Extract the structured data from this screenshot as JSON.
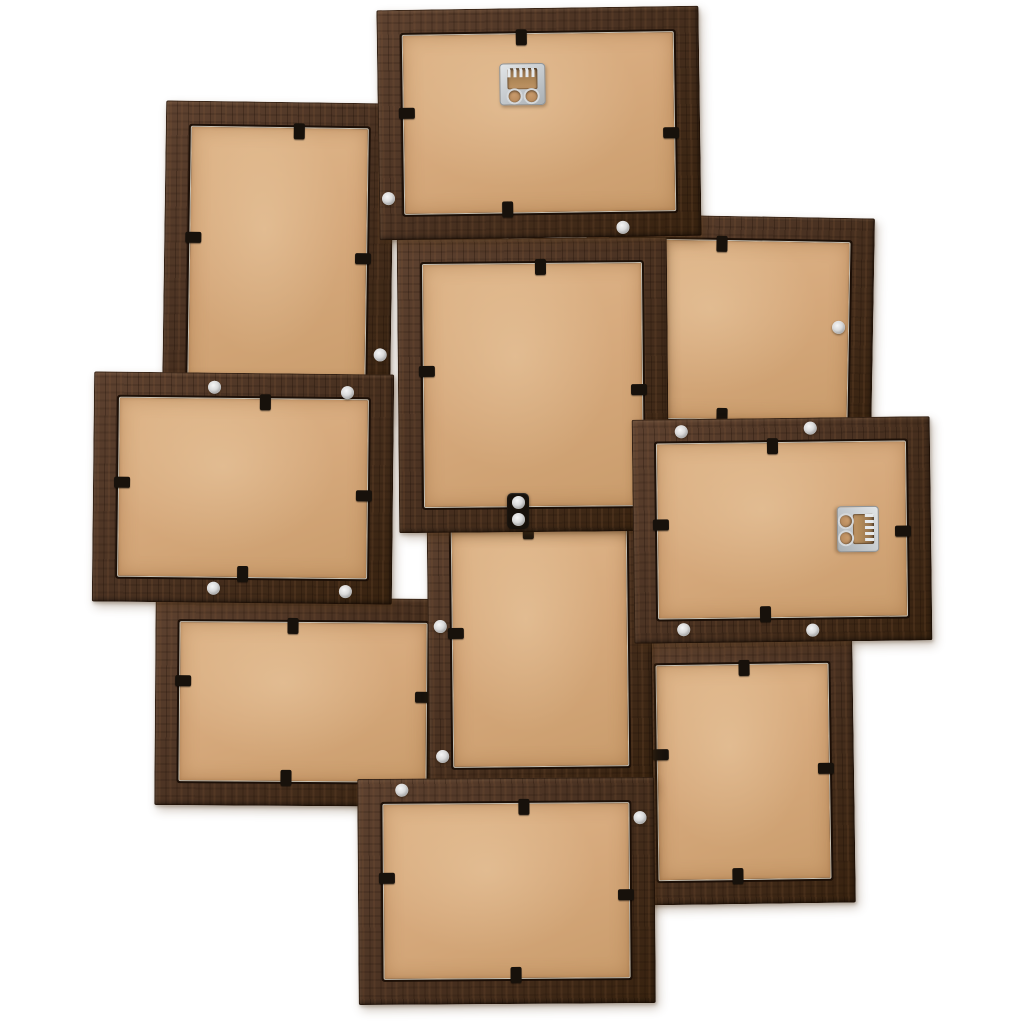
{
  "scene": {
    "subject": "back-view-of-10-photo-wooden-collage-picture-frame",
    "background": "#ffffff",
    "colors": {
      "wood": "#4a3222",
      "wood_light": "#5e4230",
      "wood_dark": "#37220f",
      "backing": "#d6a97c",
      "backing_light": "#dfb68a",
      "backing_dark": "#c99c6c",
      "clip": "#17110b",
      "screw": "#d9d9d9",
      "hanger_metal": "#c3c8cc"
    },
    "clip_size": {
      "along": 11,
      "inward": 16
    },
    "frames": [
      {
        "name": "frame-upper-left-portrait",
        "x": 164,
        "y": 102,
        "w": 228,
        "h": 318,
        "rot": 0.8,
        "rail": 26,
        "z": 1,
        "clips": [
          {
            "side": "top",
            "pos": 0.585
          },
          {
            "side": "left",
            "pos": 0.43
          },
          {
            "side": "right",
            "pos": 0.49
          }
        ],
        "screws": [
          {
            "fx": 0.955,
            "fy": 0.79
          }
        ],
        "hanger": null
      },
      {
        "name": "frame-upper-right-landscape",
        "x": 585,
        "y": 216,
        "w": 288,
        "h": 228,
        "rot": 1.0,
        "rail": 25,
        "z": 2,
        "clips": [
          {
            "side": "top",
            "pos": 0.47
          },
          {
            "side": "bottom",
            "pos": 0.48
          }
        ],
        "screws": [
          {
            "fx": 0.88,
            "fy": 0.48
          }
        ],
        "hanger": null
      },
      {
        "name": "frame-lower-right-portrait",
        "x": 633,
        "y": 640,
        "w": 221,
        "h": 264,
        "rot": -0.8,
        "rail": 25,
        "z": 3,
        "clips": [
          {
            "side": "top",
            "pos": 0.51
          },
          {
            "side": "left",
            "pos": 0.43
          },
          {
            "side": "right",
            "pos": 0.49
          },
          {
            "side": "bottom",
            "pos": 0.47
          }
        ],
        "screws": [
          {
            "fx": 0.05,
            "fy": 0.085
          }
        ],
        "hanger": null
      },
      {
        "name": "frame-lower-left-landscape",
        "x": 155,
        "y": 598,
        "w": 296,
        "h": 208,
        "rot": 0.4,
        "rail": 25,
        "z": 4,
        "clips": [
          {
            "side": "top",
            "pos": 0.465
          },
          {
            "side": "left",
            "pos": 0.4
          },
          {
            "side": "right",
            "pos": 0.475
          },
          {
            "side": "bottom",
            "pos": 0.445
          }
        ],
        "screws": [],
        "hanger": null
      },
      {
        "name": "frame-lower-center-portrait",
        "x": 428,
        "y": 503,
        "w": 224,
        "h": 288,
        "rot": -0.6,
        "rail": 25,
        "z": 5,
        "clips": [
          {
            "side": "top",
            "pos": 0.455
          },
          {
            "side": "left",
            "pos": 0.45
          }
        ],
        "screws": [
          {
            "fx": 0.055,
            "fy": 0.425
          },
          {
            "fx": 0.06,
            "fy": 0.875
          }
        ],
        "hanger": null
      },
      {
        "name": "frame-center-portrait",
        "x": 398,
        "y": 238,
        "w": 270,
        "h": 294,
        "rot": -0.5,
        "rail": 26,
        "z": 6,
        "clips": [
          {
            "side": "top",
            "pos": 0.53
          },
          {
            "side": "left",
            "pos": 0.45
          },
          {
            "side": "right",
            "pos": 0.52
          }
        ],
        "screws": [],
        "hanger": null
      },
      {
        "name": "frame-left-middle-landscape",
        "x": 93,
        "y": 373,
        "w": 300,
        "h": 230,
        "rot": 0.6,
        "rail": 26,
        "z": 7,
        "clips": [
          {
            "side": "top",
            "pos": 0.57
          },
          {
            "side": "left",
            "pos": 0.48
          },
          {
            "side": "right",
            "pos": 0.53
          },
          {
            "side": "bottom",
            "pos": 0.5
          }
        ],
        "screws": [
          {
            "fx": 0.4,
            "fy": 0.065
          },
          {
            "fx": 0.845,
            "fy": 0.08
          },
          {
            "fx": 0.405,
            "fy": 0.935
          },
          {
            "fx": 0.845,
            "fy": 0.945
          }
        ],
        "hanger": null
      },
      {
        "name": "frame-top-landscape",
        "x": 378,
        "y": 8,
        "w": 322,
        "h": 230,
        "rot": -0.8,
        "rail": 26,
        "z": 8,
        "clips": [
          {
            "side": "top",
            "pos": 0.45
          },
          {
            "side": "left",
            "pos": 0.45
          },
          {
            "side": "right",
            "pos": 0.55
          },
          {
            "side": "bottom",
            "pos": 0.4
          }
        ],
        "screws": [
          {
            "fx": 0.755,
            "fy": 0.96
          },
          {
            "fx": 0.03,
            "fy": 0.82
          }
        ],
        "hanger": {
          "orient": "horizontal",
          "fx": 0.45,
          "fy": 0.33
        }
      },
      {
        "name": "frame-right-landscape",
        "x": 633,
        "y": 418,
        "w": 298,
        "h": 224,
        "rot": -0.7,
        "rail": 25,
        "z": 9,
        "clips": [
          {
            "side": "top",
            "pos": 0.47
          },
          {
            "side": "left",
            "pos": 0.47
          },
          {
            "side": "right",
            "pos": 0.51
          },
          {
            "side": "bottom",
            "pos": 0.44
          }
        ],
        "screws": [
          {
            "fx": 0.165,
            "fy": 0.055
          },
          {
            "fx": 0.6,
            "fy": 0.045
          },
          {
            "fx": 0.165,
            "fy": 0.94
          },
          {
            "fx": 0.6,
            "fy": 0.95
          }
        ],
        "hanger": {
          "orient": "vertical",
          "fx": 0.755,
          "fy": 0.5
        }
      },
      {
        "name": "frame-bottom-landscape",
        "x": 358,
        "y": 778,
        "w": 297,
        "h": 226,
        "rot": -0.4,
        "rail": 26,
        "z": 10,
        "clips": [
          {
            "side": "top",
            "pos": 0.56
          },
          {
            "side": "left",
            "pos": 0.44
          },
          {
            "side": "right",
            "pos": 0.52
          },
          {
            "side": "bottom",
            "pos": 0.53
          }
        ],
        "screws": [
          {
            "fx": 0.15,
            "fy": 0.05
          },
          {
            "fx": 0.95,
            "fy": 0.18
          }
        ],
        "hanger": null
      }
    ],
    "connector": {
      "x": 507,
      "y": 493,
      "w": 22,
      "h": 36,
      "screws": [
        {
          "fx": 0.5,
          "fy": 0.26
        },
        {
          "fx": 0.5,
          "fy": 0.74
        }
      ]
    }
  }
}
